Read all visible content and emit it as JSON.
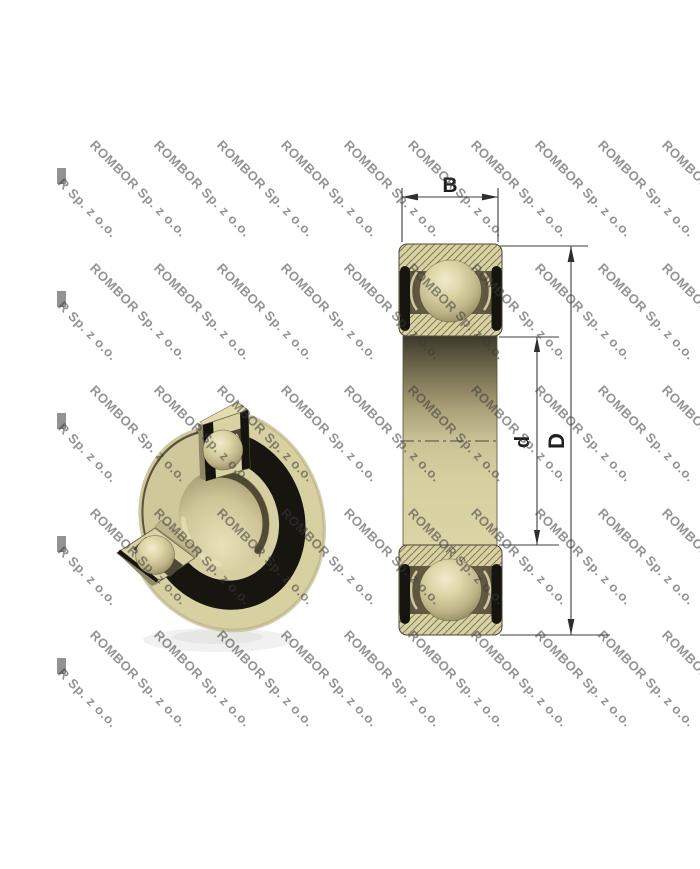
{
  "canvas": {
    "width": 700,
    "height": 869,
    "background": "#ffffff"
  },
  "watermark": {
    "text": "ROMBOR Sp. z o.o.",
    "partial_text": "R Sp. z o.o.",
    "color": "rgba(58,58,58,0.55)",
    "angle_deg": 45,
    "columns_x": [
      33.5,
      97,
      160.5,
      224,
      287.5,
      351,
      414.5,
      478,
      541.5,
      605,
      668.5
    ],
    "rows_y": [
      138,
      260.5,
      383,
      505.5,
      628
    ]
  },
  "diagram": {
    "dimension_labels": {
      "width": "B",
      "outer_diameter": "D",
      "bore_diameter": "d"
    },
    "colors": {
      "bearing_tan": "#d6cf9e",
      "bearing_tan_light": "#e9e3ba",
      "bearing_tan_dark": "#8f8762",
      "seal_black": "#16140f",
      "cavity_olive": "#4e4836",
      "dimension_line": "#3c3c3c",
      "watermark_gray": "#999999"
    }
  }
}
